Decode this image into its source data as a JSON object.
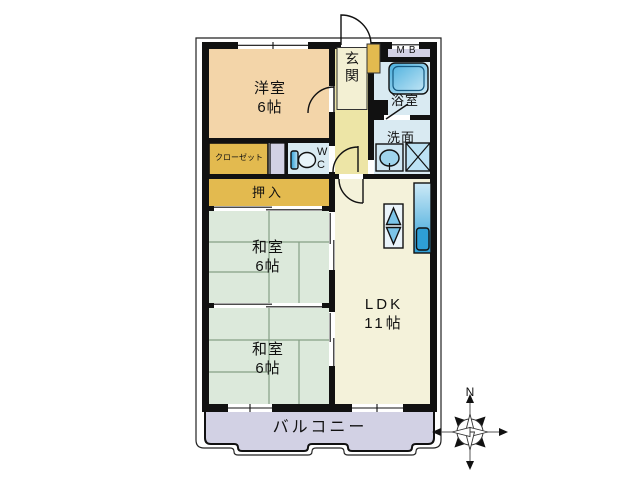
{
  "title": "3LDK apartment floor plan",
  "labels": {
    "western_room": "洋室\n6帖",
    "entrance": "玄関",
    "meter_box": "MB",
    "bathroom": "浴室",
    "washroom": "洗面",
    "closet": "クローゼット",
    "toilet": "WC",
    "oshiire": "押入",
    "japanese_room_1": "和室\n6帖",
    "japanese_room_2": "和室\n6帖",
    "ldk": "LDK\n11帖",
    "balcony": "バルコニー"
  },
  "compass": {
    "north_label": "N"
  },
  "icons": [
    "bathtub-icon",
    "toilet-icon",
    "sink-icon",
    "washing-machine-icon",
    "stove-icon",
    "kitchen-counter-icon",
    "shoe-cabinet",
    "compass-rose"
  ],
  "colors": {
    "wall": "#111111",
    "room_west": "#F3D5A9",
    "hallway": "#EDE5A6",
    "genkan": "#F3F0D3",
    "gold": "#E3BA4F",
    "tatami": "#DCE9DB",
    "ldk": "#F4F2DA",
    "wet": "#D9EAF2",
    "lavender": "#D2D1E4",
    "fixture_blue_dark": "#2E9FD6",
    "fixture_blue_light": "#CDEAF7",
    "tatami_line": "#85A085"
  }
}
